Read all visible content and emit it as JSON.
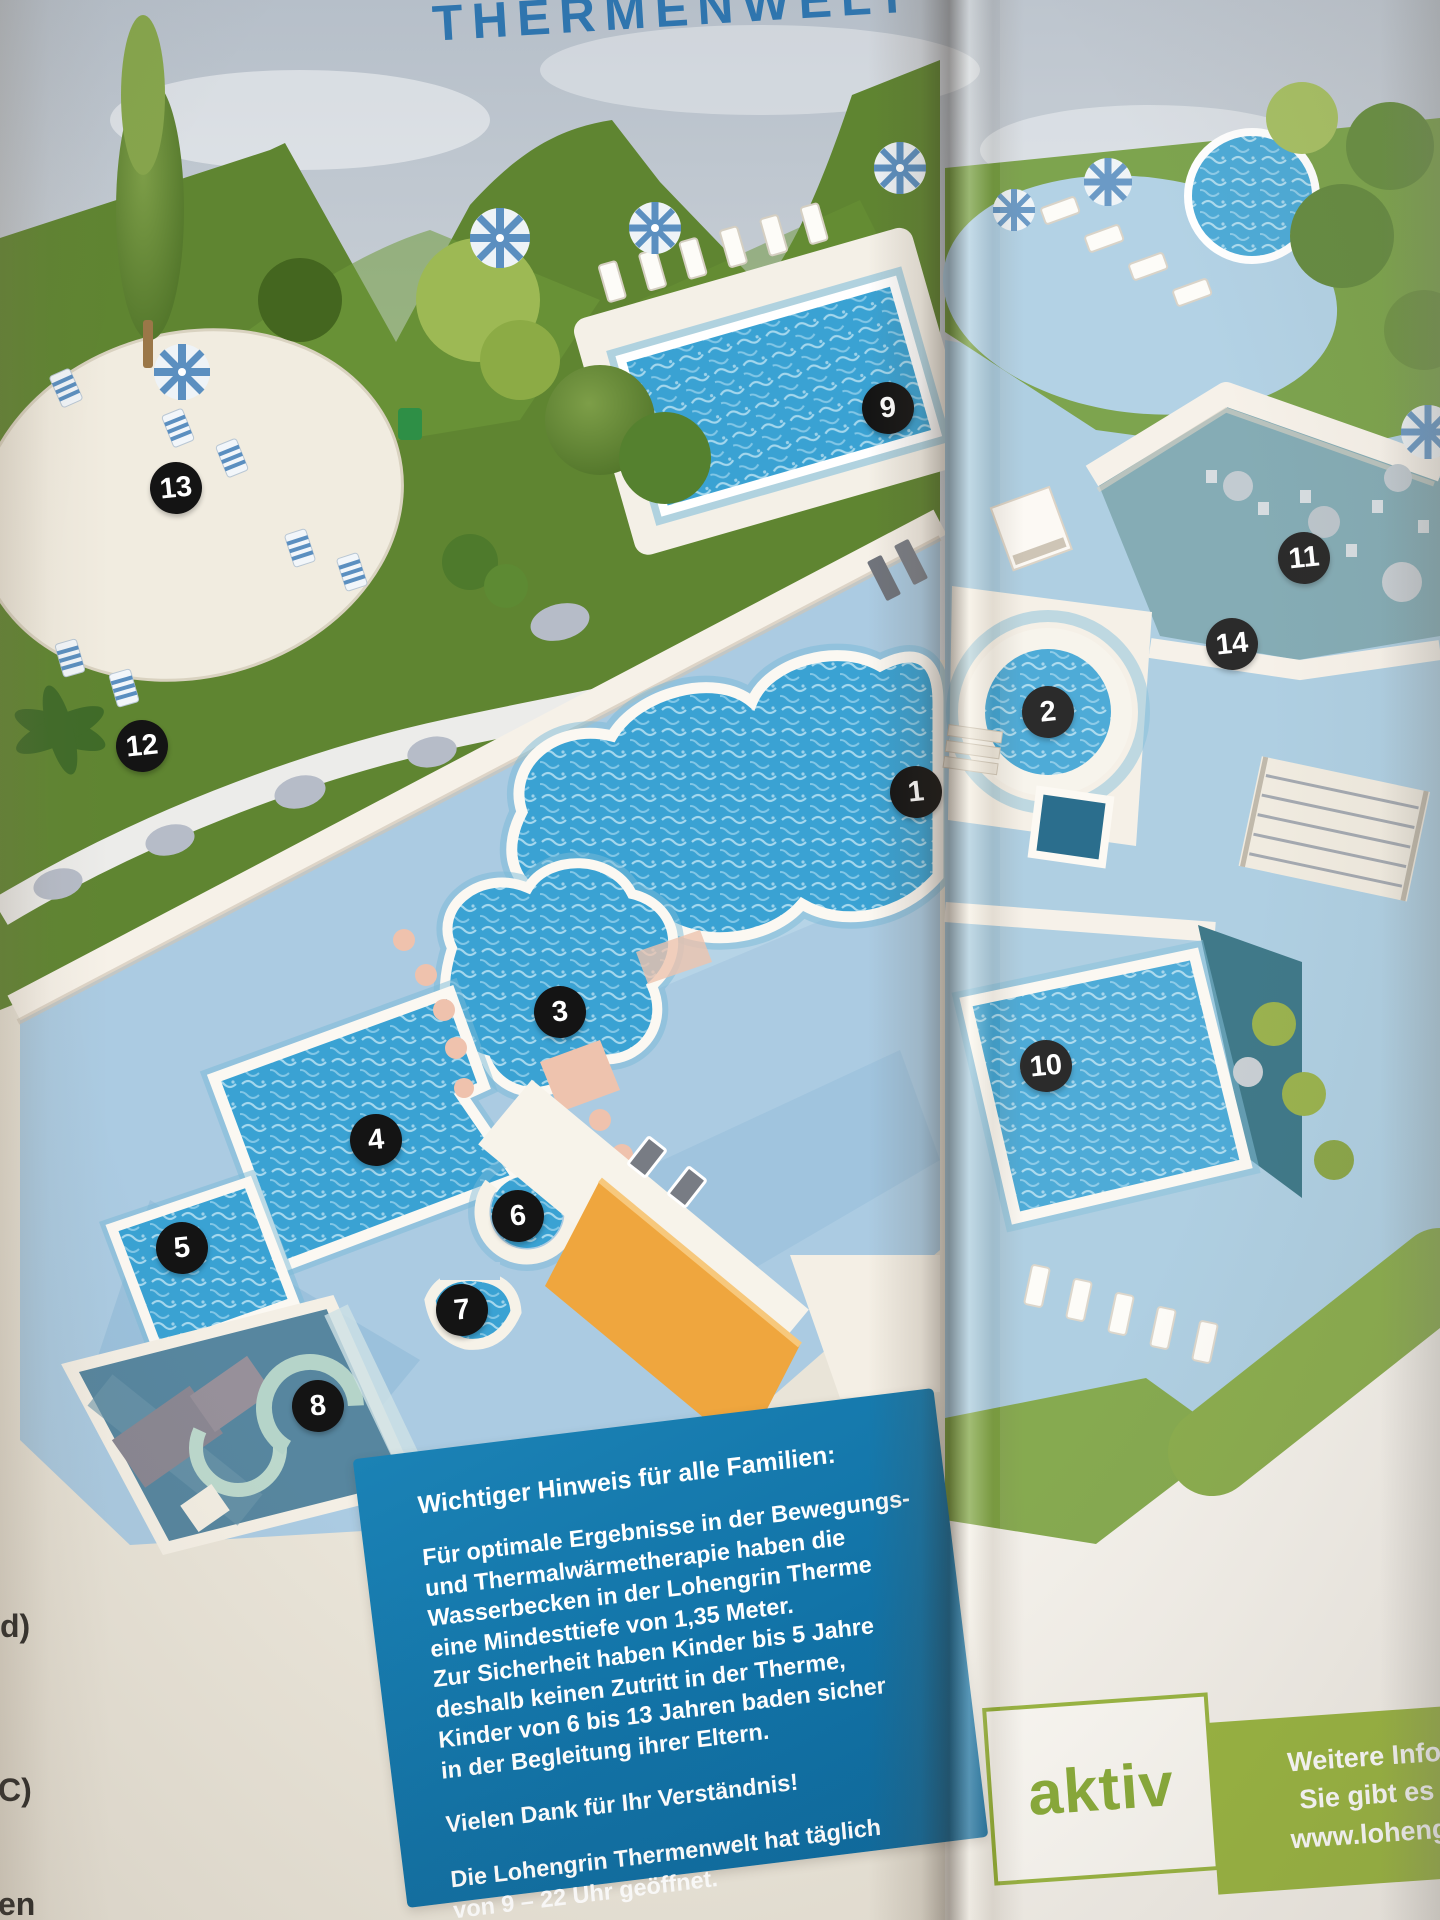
{
  "page": {
    "title": "THERMENWELT",
    "title_color": "#2f75ae"
  },
  "map": {
    "markers": [
      {
        "n": "1",
        "x": 916,
        "y": 792
      },
      {
        "n": "2",
        "x": 1048,
        "y": 712
      },
      {
        "n": "3",
        "x": 560,
        "y": 1012
      },
      {
        "n": "4",
        "x": 376,
        "y": 1140
      },
      {
        "n": "5",
        "x": 182,
        "y": 1248
      },
      {
        "n": "6",
        "x": 518,
        "y": 1216
      },
      {
        "n": "7",
        "x": 462,
        "y": 1310
      },
      {
        "n": "8",
        "x": 318,
        "y": 1406
      },
      {
        "n": "9",
        "x": 888,
        "y": 408
      },
      {
        "n": "10",
        "x": 1046,
        "y": 1066
      },
      {
        "n": "11",
        "x": 1304,
        "y": 558
      },
      {
        "n": "12",
        "x": 142,
        "y": 746
      },
      {
        "n": "13",
        "x": 176,
        "y": 488
      },
      {
        "n": "14",
        "x": 1232,
        "y": 644
      }
    ],
    "marker_color": "#141414",
    "water_color": "#3aa2d3",
    "lawn_color": "#6f9a3a"
  },
  "info_box": {
    "bg_color": "#1172a6",
    "heading": "Wichtiger Hinweis für alle Familien:",
    "body": "Für optimale Ergebnisse in der Bewegungs-\nund Thermalwärmetherapie haben die\nWasserbecken in der Lohengrin Therme\neine Mindesttiefe von 1,35 Meter.\nZur Sicherheit haben Kinder bis 5 Jahre\ndeshalb keinen Zutritt in der Therme,\nKinder von 6 bis 13 Jahren baden sicher\nin der Begleitung ihrer Eltern.",
    "thanks": "Vielen Dank für Ihr Verständnis!",
    "hours": "Die Lohengrin Thermenwelt hat täglich\nvon 9 – 22 Uhr geöffnet."
  },
  "aktiv_box": {
    "label": "aktiv",
    "green": "#8fae2d",
    "band_lines": [
      "Weitere Info",
      "Sie gibt es",
      "www.loheng"
    ]
  },
  "page_edge": {
    "fragments": [
      {
        "text": "d)",
        "x": 0,
        "y": 1608
      },
      {
        "text": ")",
        "x": -10,
        "y": 1658
      },
      {
        "text": "C)",
        "x": -2,
        "y": 1772
      },
      {
        "text": "en",
        "x": -2,
        "y": 1886
      }
    ]
  }
}
